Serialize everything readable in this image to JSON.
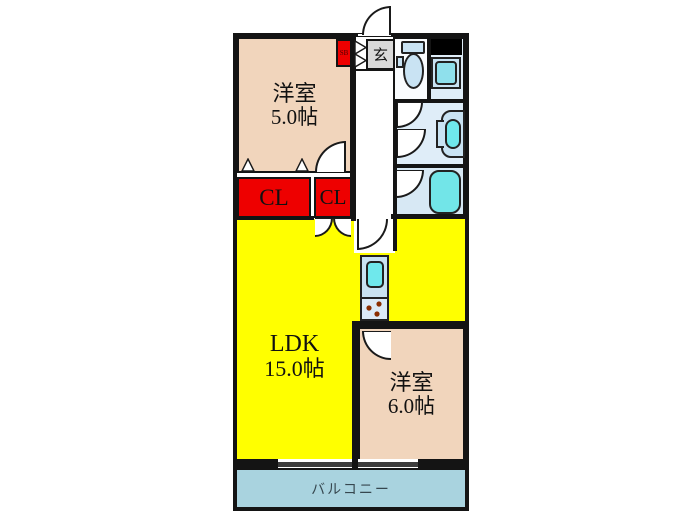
{
  "title": "マンション間取り図",
  "rooms": {
    "room5": {
      "name": "洋室",
      "size": "5.0帖"
    },
    "ldk": {
      "name": "LDK",
      "size": "15.0帖"
    },
    "room6": {
      "name": "洋室",
      "size": "6.0帖"
    },
    "closet_left": "CL",
    "closet_right": "CL",
    "entrance": "玄",
    "shoe_box": "SB",
    "balcony": "バルコニー"
  },
  "fixtures": {
    "toilet": "toilet",
    "washer": "washing-machine",
    "sink": "wash-basin",
    "bathtub": "bathtub",
    "kitchen": "kitchen-sink-and-stove",
    "service_duct": "pipe-space"
  },
  "colors": {
    "wall": "#141414",
    "room_pink": "#F1D5BC",
    "ldk_yellow": "#FFFF00",
    "closet_red": "#EE0000",
    "balcony_blue": "#A9D3DF",
    "water_blue": "#DFEDF8",
    "bath_blue": "#D7E8F4",
    "fixture_blue": "#C9E3F3",
    "fixture_cyan": "#6FE8EC",
    "entrance_gray": "#D9D9D9",
    "window_gray": "#3C3C3C",
    "stove_dot": "#8B2E00"
  }
}
